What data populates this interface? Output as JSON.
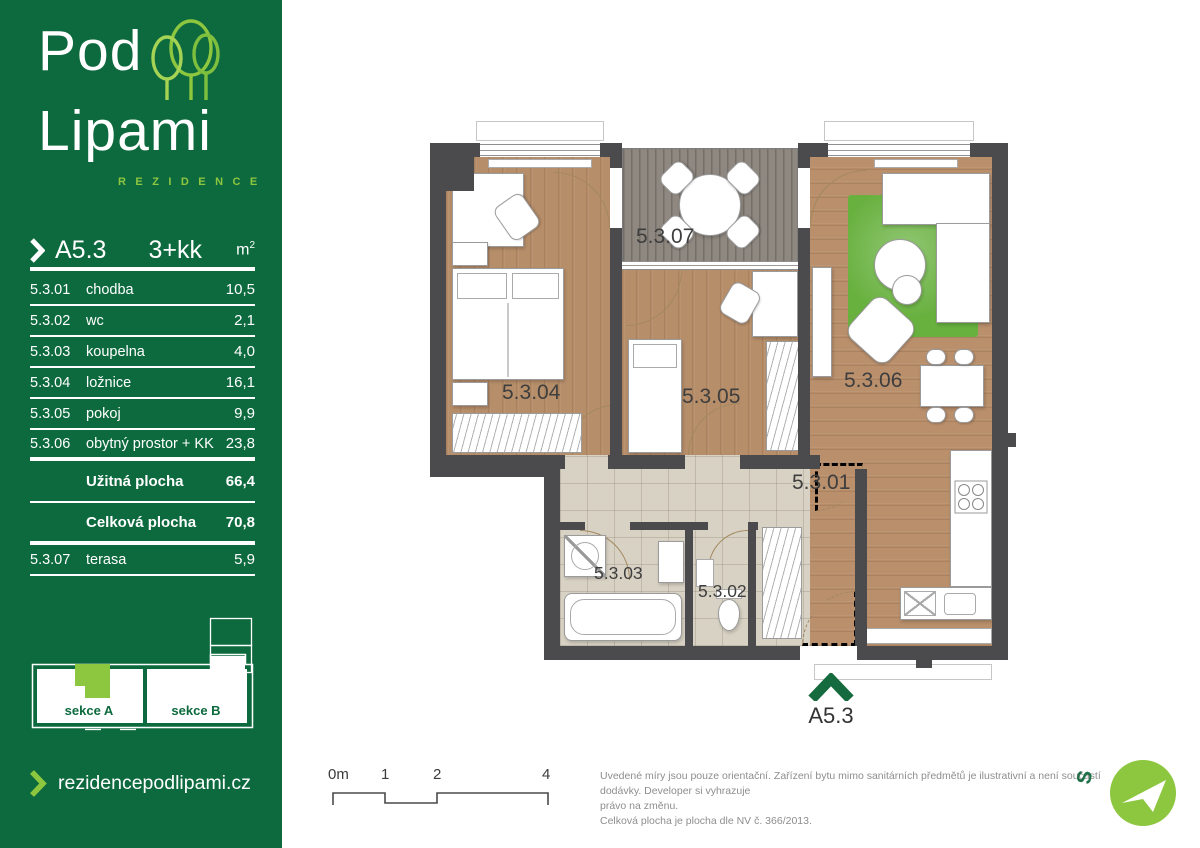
{
  "brand": {
    "line1": "Pod",
    "line2": "Lipami",
    "sub": "R E Z I D E N C E",
    "website": "rezidencepodlipami.cz"
  },
  "unit": {
    "id": "A5.3",
    "disposition": "3+kk",
    "area_unit_base": "m",
    "area_unit_sup": "2"
  },
  "rooms": [
    {
      "code": "5.3.01",
      "name": "chodba",
      "area": "10,5"
    },
    {
      "code": "5.3.02",
      "name": "wc",
      "area": "2,1"
    },
    {
      "code": "5.3.03",
      "name": "koupelna",
      "area": "4,0"
    },
    {
      "code": "5.3.04",
      "name": "ložnice",
      "area": "16,1"
    },
    {
      "code": "5.3.05",
      "name": "pokoj",
      "area": "9,9"
    },
    {
      "code": "5.3.06",
      "name": "obytný prostor + KK",
      "area": "23,8"
    }
  ],
  "totals": [
    {
      "label": "Užitná plocha",
      "value": "66,4"
    },
    {
      "label": "Celková plocha",
      "value": "70,8"
    }
  ],
  "terrace_row": {
    "code": "5.3.07",
    "name": "terasa",
    "area": "5,9"
  },
  "minimap": {
    "section_a": "sekce A",
    "section_b": "sekce B"
  },
  "plan_labels": {
    "r01": "5.3.01",
    "r02": "5.3.02",
    "r03": "5.3.03",
    "r04": "5.3.04",
    "r05": "5.3.05",
    "r06": "5.3.06",
    "r07": "5.3.07"
  },
  "entrance": {
    "label": "A5.3"
  },
  "scalebar": {
    "t0": "0m",
    "t1": "1",
    "t2": "2",
    "t3": "4"
  },
  "disclaimer": {
    "line1": "Uvedené míry jsou pouze orientační. Zařízení bytu mimo sanitárních předmětů je ilustrativní a není součástí dodávky. Developer si vyhrazuje",
    "line2": "právo na změnu.",
    "line3": "Celková plocha je plocha dle NV č. 366/2013."
  },
  "compass": {
    "north": "S"
  },
  "colors": {
    "brand_green": "#0d6a3e",
    "lime": "#8dc63f",
    "wall": "#4b4b4d",
    "wood": "#b78e6a",
    "tile": "#d8d2c4",
    "deck": "#8e8880",
    "rug": "#68b13f"
  }
}
